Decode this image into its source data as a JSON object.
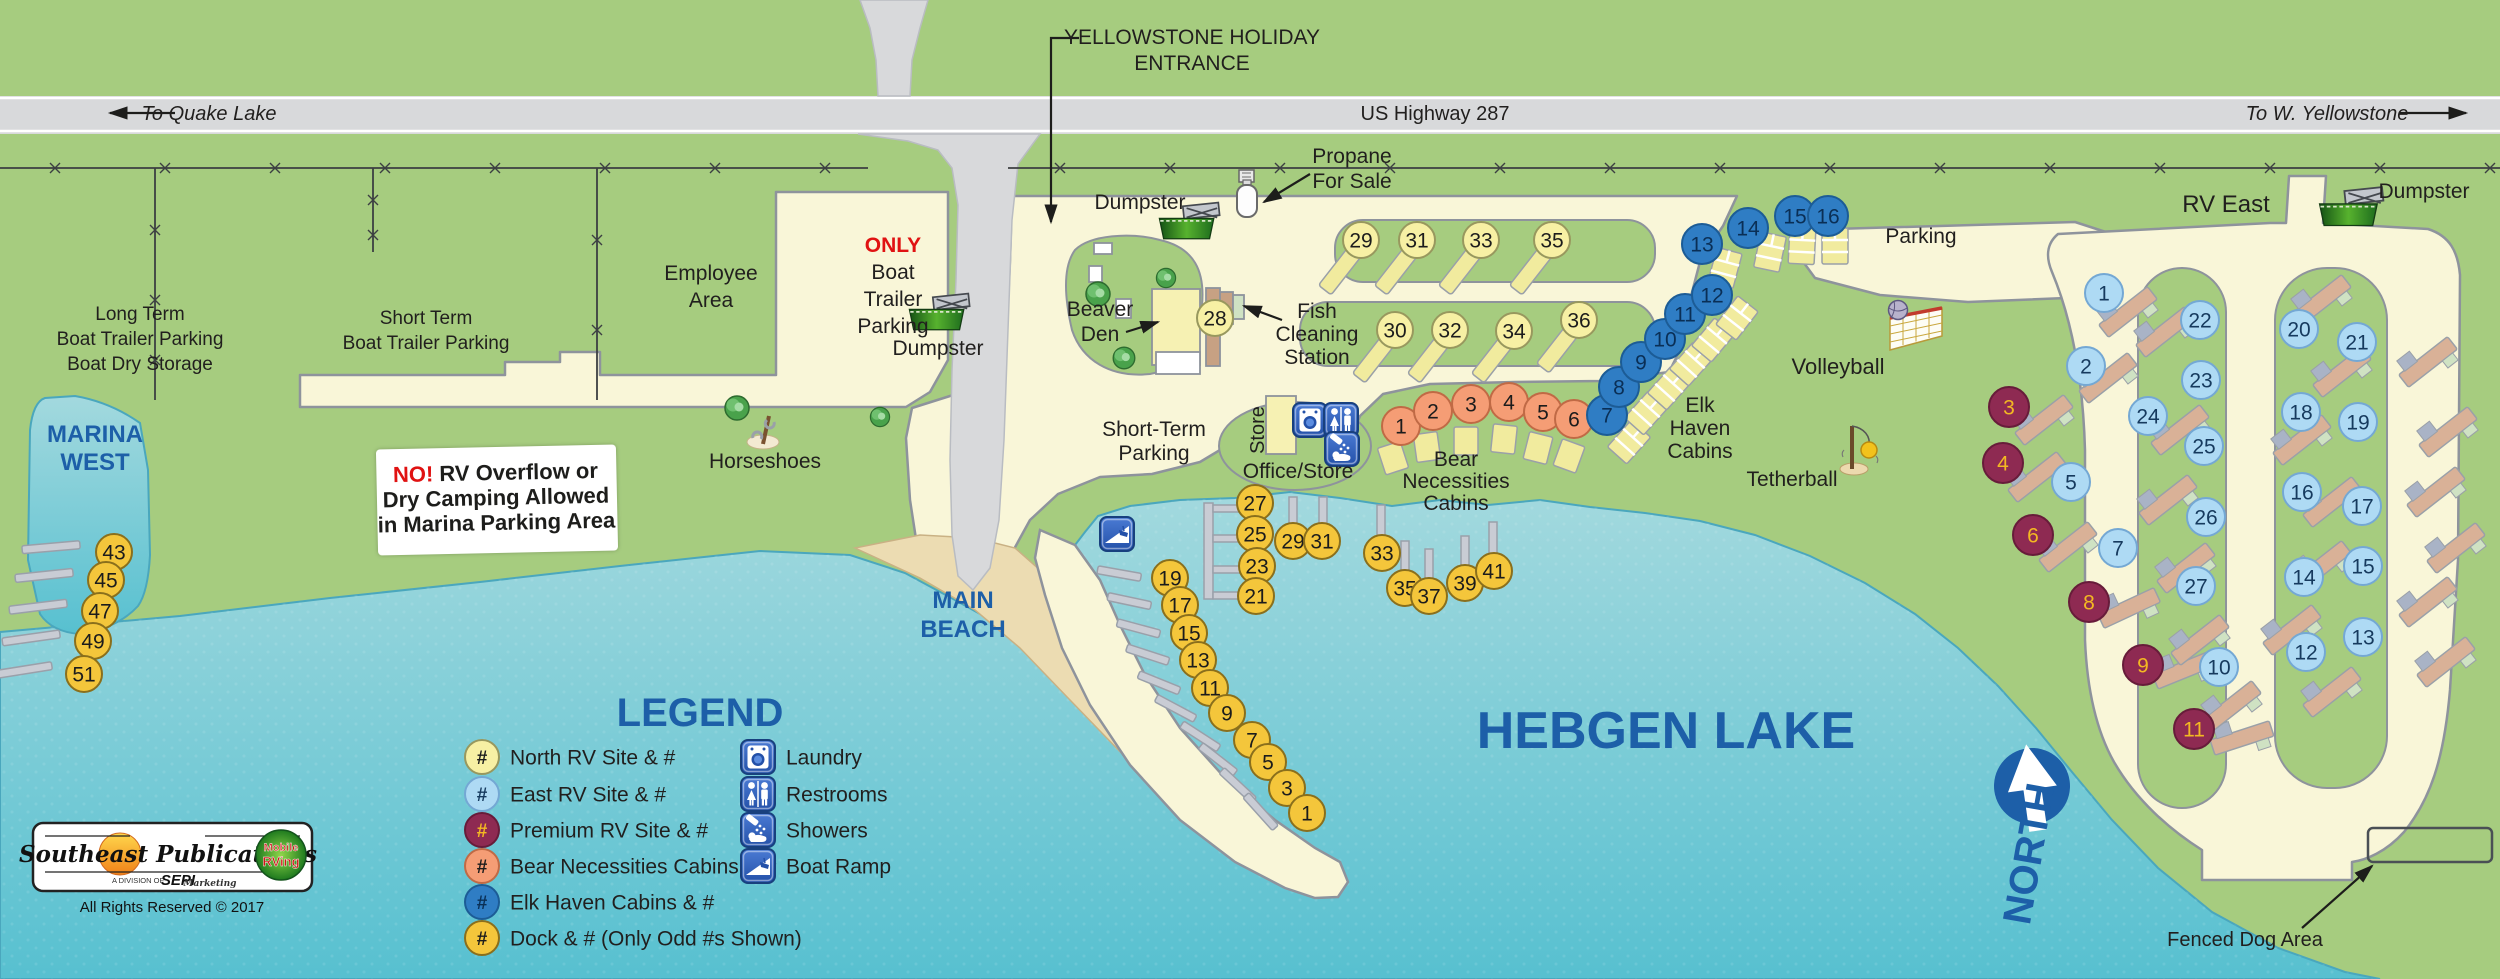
{
  "colors": {
    "grass": "#a6cc7f",
    "road": "#f9f6d8",
    "road_edge": "#8e939c",
    "highway": "#d8d9db",
    "water_top": "#a3d9de",
    "water_bottom": "#57c0d0",
    "sand": "#ecdcb2",
    "sand_edge": "#c9b184",
    "blue_label": "#1d5fa8",
    "dark_text": "#211f1e",
    "red": "#e01212",
    "building": "#f6f1b3",
    "pad_yellow": "#f1eb9e",
    "pad_tan": "#d9b197",
    "pad_bluegray": "#a9b3c6",
    "pad_green": "#cfe2c3"
  },
  "highway": {
    "left": "To Quake Lake",
    "center": "US Highway 287",
    "right": "To W. Yellowstone"
  },
  "north_label": "NORTH",
  "sign": {
    "no": "NO!",
    "line1": " RV Overflow or",
    "line2": "Dry Camping Allowed",
    "line3": "in Marina Parking Area"
  },
  "logo": {
    "title": "Southeast Publications",
    "division": "A DIVISION OF",
    "sepi": "SEPI",
    "marketing": "Marketing",
    "badge1": "Mobile",
    "badge2": "RVing",
    "rights": "All Rights Reserved © 2017"
  },
  "labels": [
    {
      "name": "to-quake-lake",
      "x": 209,
      "y": 120,
      "size": 20,
      "italic": true,
      "lines": [
        "To Quake Lake"
      ]
    },
    {
      "name": "us-highway-287",
      "x": 1435,
      "y": 120,
      "size": 20,
      "lines": [
        "US Highway 287"
      ]
    },
    {
      "name": "to-w-yellowstone",
      "x": 2327,
      "y": 120,
      "size": 20,
      "italic": true,
      "lines": [
        "To W. Yellowstone"
      ]
    },
    {
      "name": "entrance",
      "x": 1192,
      "y": 44,
      "size": 21,
      "lh": 26,
      "lines": [
        "YELLOWSTONE HOLIDAY",
        "ENTRANCE"
      ]
    },
    {
      "name": "propane",
      "x": 1352,
      "y": 163,
      "size": 21,
      "lh": 25,
      "lines": [
        "Propane",
        "For Sale"
      ]
    },
    {
      "name": "dumpster-center",
      "x": 1140,
      "y": 209,
      "size": 21,
      "lines": [
        "Dumpster"
      ]
    },
    {
      "name": "dumpster-left",
      "x": 938,
      "y": 355,
      "size": 21,
      "lines": [
        "Dumpster"
      ]
    },
    {
      "name": "dumpster-right",
      "x": 2424,
      "y": 198,
      "size": 21,
      "lines": [
        "Dumpster"
      ]
    },
    {
      "name": "rv-east",
      "x": 2226,
      "y": 212,
      "size": 24,
      "lines": [
        "RV East"
      ]
    },
    {
      "name": "parking",
      "x": 1921,
      "y": 243,
      "size": 21,
      "lines": [
        "Parking"
      ]
    },
    {
      "name": "long-term",
      "x": 140,
      "y": 320,
      "size": 19,
      "lh": 25,
      "lines": [
        "Long Term",
        "Boat Trailer Parking",
        "Boat Dry Storage"
      ]
    },
    {
      "name": "marina-west",
      "x": 95,
      "y": 442,
      "size": 24,
      "lh": 28,
      "style": "blue",
      "lines": [
        "MARINA",
        "WEST"
      ]
    },
    {
      "name": "short-term-boat",
      "x": 426,
      "y": 324,
      "size": 19,
      "lh": 25,
      "lines": [
        "Short Term",
        "Boat Trailer Parking"
      ]
    },
    {
      "name": "employee-area",
      "x": 711,
      "y": 280,
      "size": 21,
      "lh": 27,
      "lines": [
        "Employee",
        "Area"
      ]
    },
    {
      "name": "only-boat-trailer",
      "x": 893,
      "y": 252,
      "size": 21,
      "lh": 27,
      "lines": [
        {
          "t": "ONLY",
          "fill": "#e01212",
          "bold": true
        },
        "Boat",
        "Trailer",
        "Parking"
      ]
    },
    {
      "name": "beaver-den",
      "x": 1100,
      "y": 316,
      "size": 21,
      "lh": 25,
      "lines": [
        "Beaver",
        "Den"
      ]
    },
    {
      "name": "fish-cleaning",
      "x": 1317,
      "y": 318,
      "size": 21,
      "lh": 23,
      "lines": [
        "Fish",
        "Cleaning",
        "Station"
      ]
    },
    {
      "name": "short-term-parking",
      "x": 1154,
      "y": 436,
      "size": 21,
      "lh": 24,
      "lines": [
        "Short-Term",
        "Parking"
      ]
    },
    {
      "name": "office-store",
      "x": 1298,
      "y": 478,
      "size": 21,
      "lines": [
        "Office/Store"
      ]
    },
    {
      "name": "store",
      "x": 1264,
      "y": 430,
      "size": 20,
      "rotate": -90,
      "lines": [
        "Store"
      ]
    },
    {
      "name": "bear-necessities",
      "x": 1456,
      "y": 466,
      "size": 21,
      "lh": 22,
      "lines": [
        "Bear",
        "Necessities",
        "Cabins"
      ]
    },
    {
      "name": "elk-haven",
      "x": 1700,
      "y": 412,
      "size": 21,
      "lh": 23,
      "lines": [
        "Elk",
        "Haven",
        "Cabins"
      ]
    },
    {
      "name": "volleyball",
      "x": 1838,
      "y": 374,
      "size": 22,
      "lines": [
        "Volleyball"
      ]
    },
    {
      "name": "tetherball",
      "x": 1792,
      "y": 486,
      "size": 21,
      "lines": [
        "Tetherball"
      ]
    },
    {
      "name": "main-beach",
      "x": 963,
      "y": 608,
      "size": 24,
      "lh": 29,
      "style": "blue",
      "lines": [
        "MAIN",
        "BEACH"
      ]
    },
    {
      "name": "hebgen-lake",
      "x": 1666,
      "y": 748,
      "size": 52,
      "style": "blue",
      "lines": [
        "HEBGEN LAKE"
      ]
    },
    {
      "name": "horseshoes",
      "x": 765,
      "y": 468,
      "size": 21,
      "lines": [
        "Horseshoes"
      ]
    },
    {
      "name": "fenced-dog-area",
      "x": 2245,
      "y": 946,
      "size": 20,
      "lines": [
        "Fenced Dog Area"
      ]
    }
  ],
  "site_style": {
    "north": {
      "fill": "#f7f0a4",
      "stroke": "#98985e",
      "text": "#1c1c1c",
      "r": 18
    },
    "dock": {
      "fill": "#f4c63b",
      "stroke": "#8a6f1c",
      "text": "#1c1c1c",
      "r": 18
    },
    "east": {
      "fill": "#aedaf4",
      "stroke": "#74a8d4",
      "text": "#163a5e",
      "r": 19
    },
    "elk": {
      "fill": "#2f7dc4",
      "stroke": "#1c5c96",
      "text": "#0a2f56",
      "r": 20
    },
    "premium": {
      "fill": "#8e2a52",
      "stroke": "#671c3a",
      "text": "#f3b822",
      "r": 20
    },
    "bear": {
      "fill": "#f59d75",
      "stroke": "#c06a45",
      "text": "#1c1c1c",
      "r": 19
    }
  },
  "sites": {
    "north": [
      [
        28,
        1215,
        318
      ],
      [
        29,
        1361,
        240
      ],
      [
        30,
        1395,
        330
      ],
      [
        31,
        1417,
        240
      ],
      [
        32,
        1450,
        330
      ],
      [
        33,
        1481,
        240
      ],
      [
        34,
        1514,
        331
      ],
      [
        35,
        1552,
        240
      ],
      [
        36,
        1579,
        320
      ]
    ],
    "bear": [
      [
        1,
        1401,
        426
      ],
      [
        2,
        1433,
        411
      ],
      [
        3,
        1471,
        404
      ],
      [
        4,
        1509,
        402
      ],
      [
        5,
        1543,
        412
      ],
      [
        6,
        1574,
        419
      ]
    ],
    "elk": [
      [
        7,
        1607,
        415
      ],
      [
        8,
        1619,
        387
      ],
      [
        9,
        1641,
        362
      ],
      [
        10,
        1665,
        339
      ],
      [
        11,
        1685,
        314
      ],
      [
        12,
        1712,
        295
      ],
      [
        13,
        1702,
        244
      ],
      [
        14,
        1748,
        228
      ],
      [
        15,
        1795,
        216
      ],
      [
        16,
        1828,
        216
      ]
    ],
    "east": [
      [
        1,
        2104,
        293
      ],
      [
        2,
        2086,
        366
      ],
      [
        5,
        2071,
        482
      ],
      [
        7,
        2118,
        548
      ],
      [
        10,
        2219,
        667
      ],
      [
        12,
        2306,
        652
      ],
      [
        13,
        2363,
        637
      ],
      [
        14,
        2304,
        577
      ],
      [
        15,
        2363,
        566
      ],
      [
        16,
        2302,
        492
      ],
      [
        17,
        2362,
        506
      ],
      [
        18,
        2301,
        412
      ],
      [
        19,
        2358,
        422
      ],
      [
        20,
        2299,
        329
      ],
      [
        21,
        2357,
        342
      ],
      [
        22,
        2200,
        320
      ],
      [
        23,
        2201,
        380
      ],
      [
        24,
        2148,
        416
      ],
      [
        25,
        2204,
        446
      ],
      [
        26,
        2206,
        517
      ],
      [
        27,
        2196,
        586
      ]
    ],
    "premium": [
      [
        3,
        2009,
        407
      ],
      [
        4,
        2003,
        463
      ],
      [
        6,
        2033,
        535
      ],
      [
        8,
        2089,
        602
      ],
      [
        9,
        2143,
        665
      ],
      [
        11,
        2194,
        729
      ]
    ],
    "dock": [
      [
        27,
        1255,
        503
      ],
      [
        25,
        1255,
        534
      ],
      [
        23,
        1257,
        566
      ],
      [
        21,
        1256,
        596
      ],
      [
        29,
        1293,
        541
      ],
      [
        31,
        1322,
        541
      ],
      [
        33,
        1382,
        553
      ],
      [
        35,
        1405,
        588
      ],
      [
        37,
        1429,
        596
      ],
      [
        39,
        1465,
        583
      ],
      [
        41,
        1494,
        571
      ],
      [
        19,
        1170,
        578
      ],
      [
        17,
        1180,
        605
      ],
      [
        15,
        1189,
        633
      ],
      [
        13,
        1198,
        660
      ],
      [
        11,
        1210,
        688
      ],
      [
        9,
        1227,
        713
      ],
      [
        7,
        1252,
        740
      ],
      [
        5,
        1268,
        762
      ],
      [
        3,
        1287,
        788
      ],
      [
        1,
        1307,
        813
      ],
      [
        43,
        114,
        552
      ],
      [
        45,
        106,
        580
      ],
      [
        47,
        100,
        611
      ],
      [
        49,
        93,
        641
      ],
      [
        51,
        84,
        674
      ]
    ]
  },
  "piers": {
    "rects": [
      [
        1204,
        503,
        9,
        96
      ],
      [
        1213,
        505,
        36,
        7
      ],
      [
        1213,
        535,
        36,
        7
      ],
      [
        1213,
        566,
        36,
        7
      ],
      [
        1213,
        592,
        36,
        7
      ],
      [
        1289,
        497,
        8,
        38
      ],
      [
        1319,
        497,
        8,
        38
      ],
      [
        1377,
        505,
        8,
        44
      ],
      [
        1401,
        541,
        8,
        44
      ],
      [
        1425,
        549,
        8,
        42
      ],
      [
        1461,
        536,
        8,
        42
      ],
      [
        1489,
        522,
        8,
        42
      ]
    ],
    "angled": [
      [
        1133,
        576,
        10,
        44
      ],
      [
        1143,
        604,
        12,
        44
      ],
      [
        1152,
        632,
        15,
        44
      ],
      [
        1161,
        659,
        18,
        44
      ],
      [
        1172,
        688,
        22,
        44
      ],
      [
        1188,
        715,
        28,
        44
      ],
      [
        1212,
        744,
        33,
        44
      ],
      [
        1229,
        768,
        38,
        44
      ],
      [
        1248,
        795,
        43,
        44
      ],
      [
        1270,
        822,
        48,
        44
      ],
      [
        65,
        546,
        -5,
        58
      ],
      [
        58,
        574,
        -6,
        58
      ],
      [
        52,
        605,
        -7,
        58
      ],
      [
        45,
        636,
        -8,
        58
      ],
      [
        37,
        668,
        -9,
        58
      ]
    ]
  },
  "pads": {
    "strip": [
      [
        1342,
        268,
        38
      ],
      [
        1398,
        268,
        38
      ],
      [
        1462,
        268,
        38
      ],
      [
        1533,
        268,
        38
      ],
      [
        1376,
        356,
        38
      ],
      [
        1431,
        356,
        38
      ],
      [
        1495,
        356,
        38
      ],
      [
        1560,
        346,
        38
      ]
    ],
    "cabin": [
      [
        1393,
        458,
        -18
      ],
      [
        1427,
        447,
        -8
      ],
      [
        1466,
        441,
        0
      ],
      [
        1504,
        439,
        6
      ],
      [
        1538,
        448,
        14
      ],
      [
        1569,
        456,
        20
      ]
    ],
    "elk": [
      [
        1629,
        442,
        42
      ],
      [
        1646,
        413,
        42
      ],
      [
        1669,
        388,
        42
      ],
      [
        1691,
        364,
        42
      ],
      [
        1713,
        340,
        40
      ],
      [
        1737,
        318,
        38
      ],
      [
        1725,
        268,
        15
      ],
      [
        1770,
        252,
        12
      ],
      [
        1802,
        246,
        3
      ],
      [
        1835,
        246,
        0
      ]
    ],
    "rv": [
      [
        2128,
        312,
        -38
      ],
      [
        2108,
        378,
        -38
      ],
      [
        2044,
        420,
        -38
      ],
      [
        2037,
        477,
        -38
      ],
      [
        2068,
        547,
        -38
      ],
      [
        2129,
        608,
        -25
      ],
      [
        2184,
        670,
        -22
      ],
      [
        2242,
        738,
        -18
      ],
      [
        2165,
        332,
        -38
      ],
      [
        2180,
        430,
        -38
      ],
      [
        2168,
        500,
        -38
      ],
      [
        2186,
        568,
        -38
      ],
      [
        2200,
        640,
        -38
      ],
      [
        2232,
        706,
        -38
      ],
      [
        2322,
        300,
        -38
      ],
      [
        2342,
        372,
        -38
      ],
      [
        2302,
        440,
        -38
      ],
      [
        2332,
        502,
        -38
      ],
      [
        2322,
        566,
        -38
      ],
      [
        2292,
        630,
        -38
      ],
      [
        2332,
        692,
        -38
      ],
      [
        2428,
        362,
        -38
      ],
      [
        2448,
        432,
        -38
      ],
      [
        2436,
        492,
        -38
      ],
      [
        2456,
        548,
        -38
      ],
      [
        2428,
        602,
        -38
      ],
      [
        2446,
        662,
        -38
      ]
    ]
  },
  "buildings": [
    [
      1266,
      396,
      30,
      58,
      "bldg"
    ],
    [
      1152,
      289,
      48,
      76,
      "bldg"
    ],
    [
      1156,
      352,
      44,
      22,
      "deck"
    ],
    [
      1094,
      243,
      18,
      11,
      "deck"
    ],
    [
      1089,
      266,
      13,
      16,
      "deck"
    ],
    [
      1116,
      299,
      15,
      19,
      "deck"
    ],
    [
      1206,
      288,
      14,
      78,
      "walk"
    ],
    [
      1220,
      292,
      13,
      32,
      "walk"
    ],
    [
      1233,
      295,
      11,
      24,
      "fishg"
    ]
  ],
  "icons": [
    [
      "dumpster",
      1190,
      226,
      0.85
    ],
    [
      "dumpster",
      940,
      317,
      0.85
    ],
    [
      "dumpster",
      2352,
      212,
      0.9
    ],
    [
      "propane",
      1247,
      200,
      1
    ],
    [
      "laundry",
      1310,
      420,
      1
    ],
    [
      "restrooms",
      1341,
      420,
      1
    ],
    [
      "showers",
      1342,
      449,
      1
    ],
    [
      "boatramp",
      1117,
      534,
      1
    ],
    [
      "tree",
      737,
      408,
      1
    ],
    [
      "tree",
      880,
      417,
      0.8
    ],
    [
      "tree",
      1098,
      294,
      1
    ],
    [
      "tree",
      1166,
      278,
      0.8
    ],
    [
      "tree",
      1124,
      358,
      0.9
    ],
    [
      "volleyball",
      1890,
      320,
      1
    ],
    [
      "tetherball",
      1852,
      452,
      1
    ],
    [
      "horseshoes",
      763,
      432,
      1
    ]
  ],
  "legend": {
    "title": "LEGEND",
    "hash": "#",
    "items": [
      {
        "type": "north",
        "label": "North RV Site & #"
      },
      {
        "type": "east",
        "label": "East RV Site & #"
      },
      {
        "type": "premium",
        "label": "Premium RV Site & #"
      },
      {
        "type": "bear",
        "label": "Bear Necessities Cabins & #"
      },
      {
        "type": "elk",
        "label": "Elk Haven Cabins & #"
      },
      {
        "type": "dock",
        "label": "Dock & # (Only Odd #s Shown)"
      }
    ],
    "facilities": [
      [
        "laundry",
        "Laundry"
      ],
      [
        "restrooms",
        "Restrooms"
      ],
      [
        "showers",
        "Showers"
      ],
      [
        "boatramp",
        "Boat Ramp"
      ]
    ]
  }
}
